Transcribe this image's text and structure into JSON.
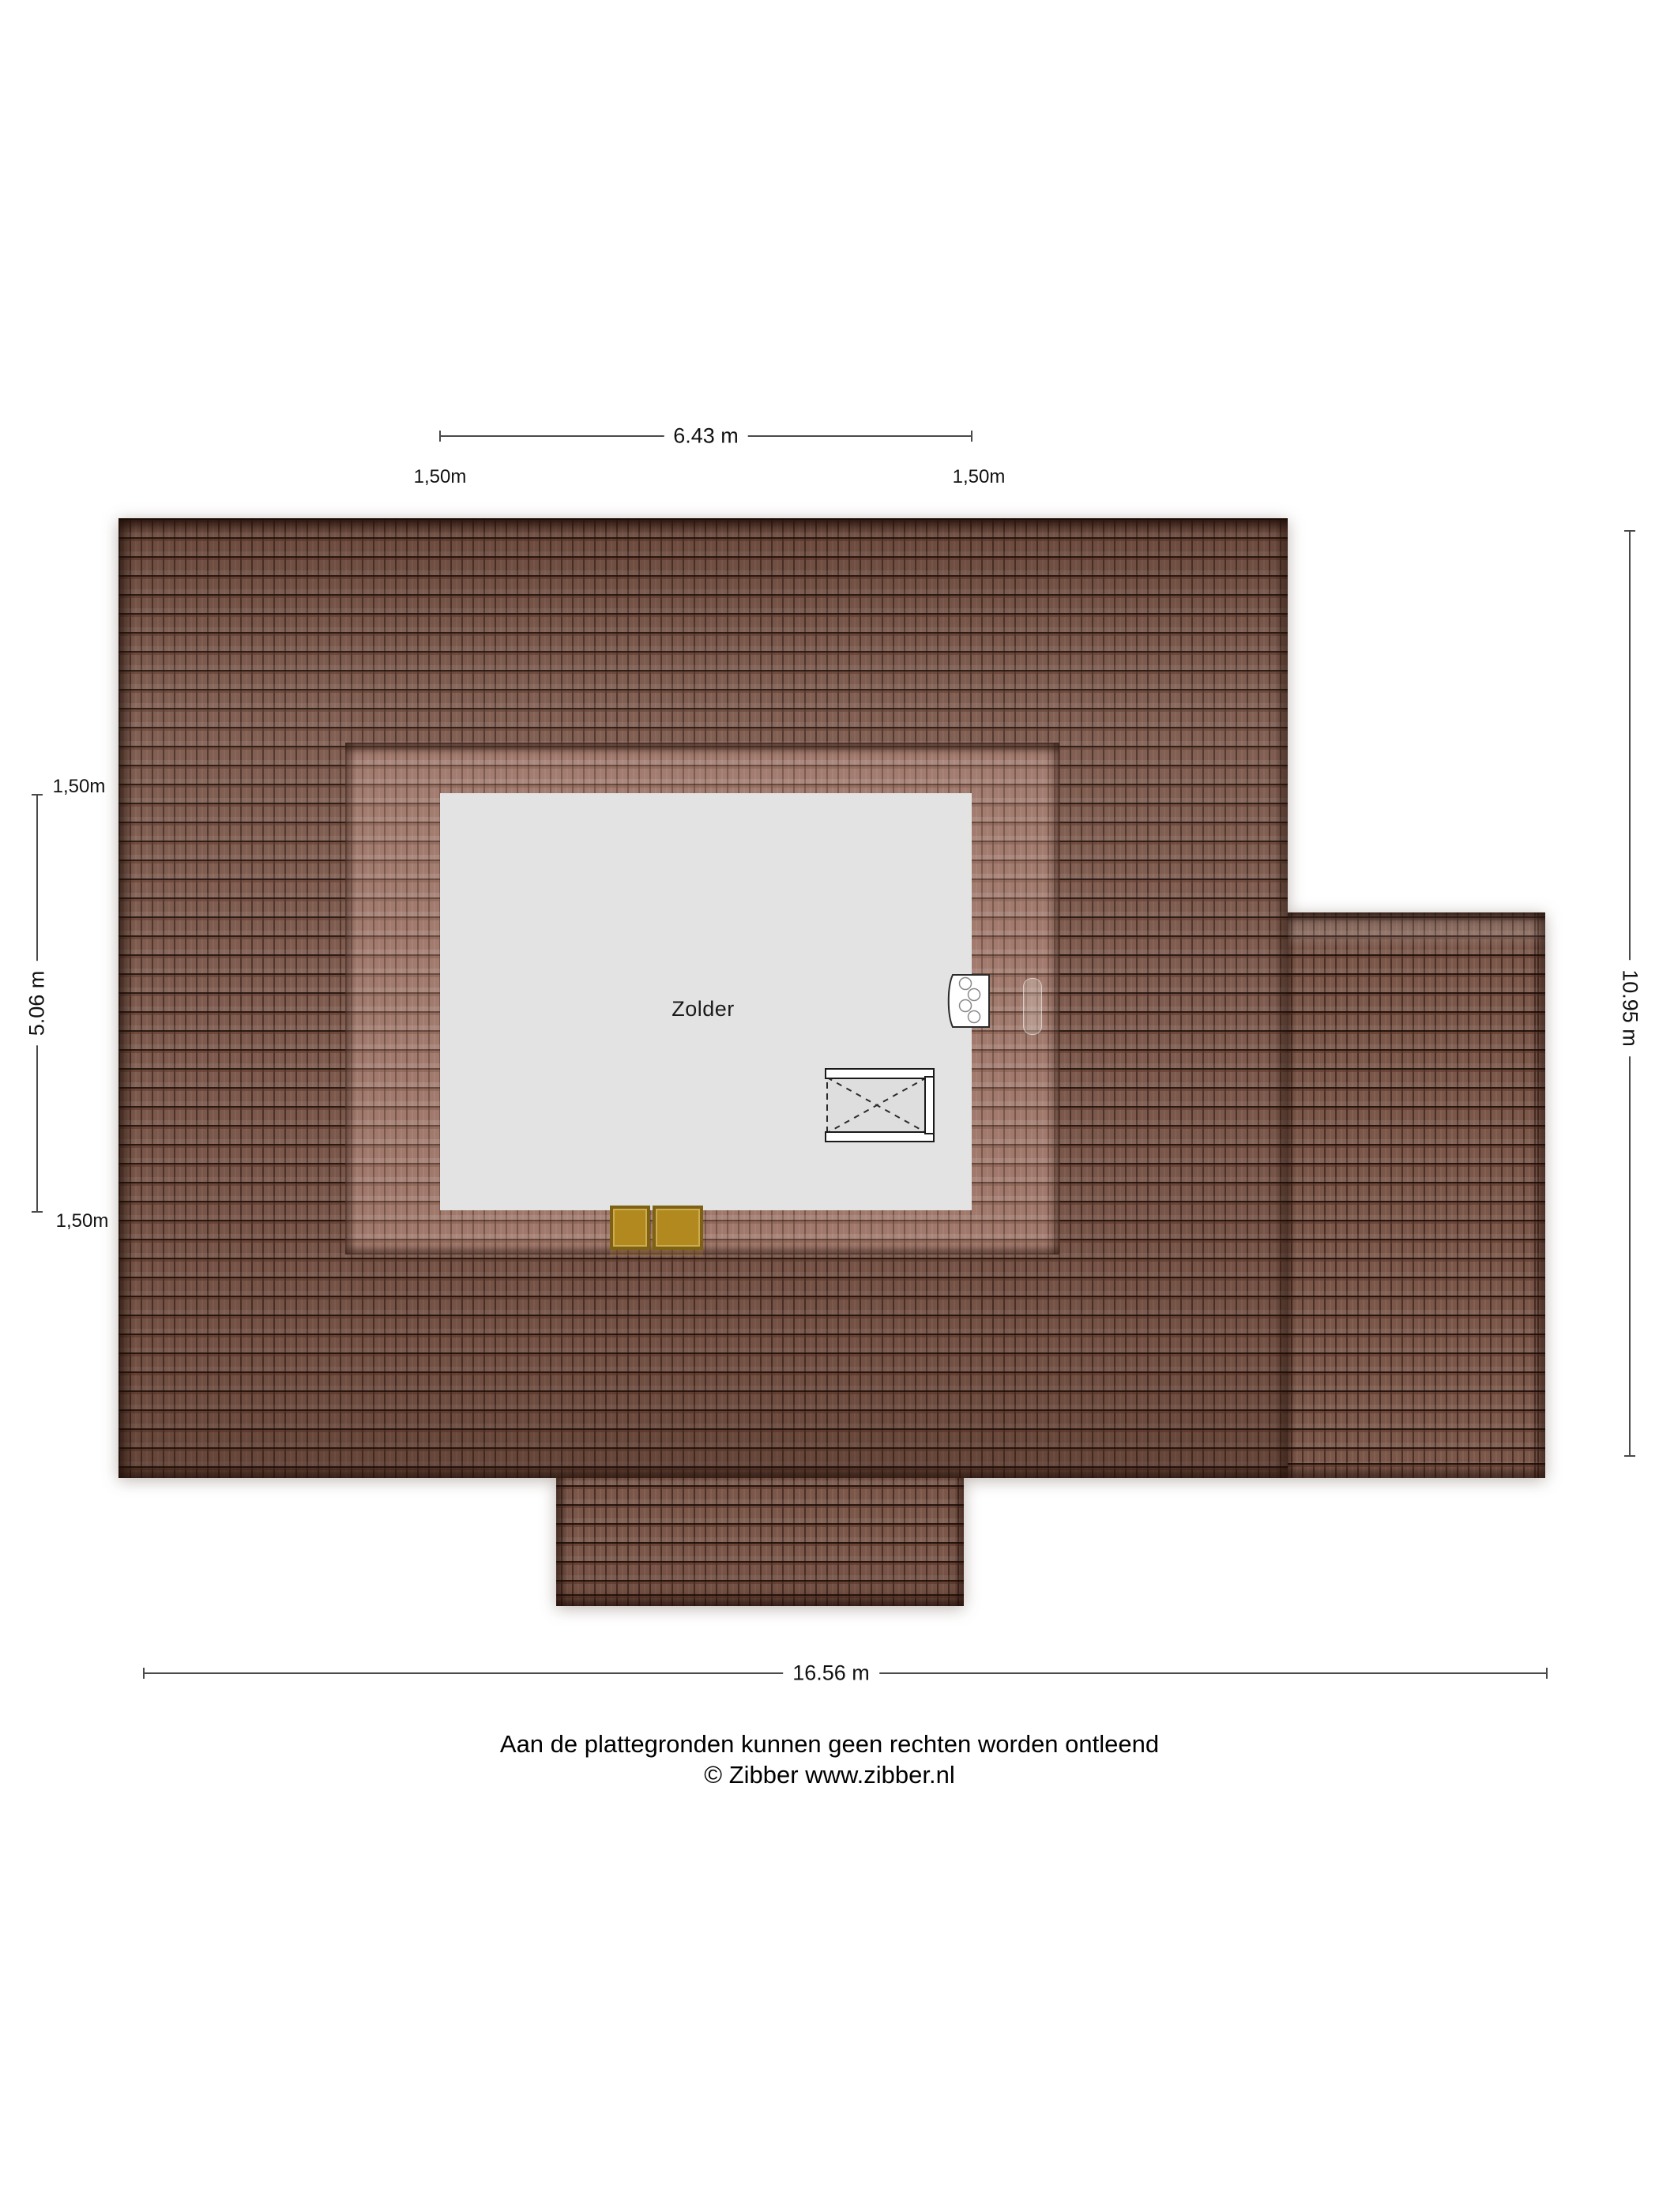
{
  "room": {
    "label": "Zolder"
  },
  "dimensions": {
    "top": {
      "value": "6.43 m",
      "flank_left": "1,50m",
      "flank_right": "1,50m"
    },
    "left": {
      "value": "5.06 m",
      "flank_top": "1,50m",
      "flank_bottom": "1,50m"
    },
    "right": {
      "value": "10.95 m"
    },
    "bottom": {
      "value": "16.56 m"
    }
  },
  "footer": {
    "disclaimer": "Aan de plattegronden kunnen geen rechten worden ontleend",
    "copyright": "© Zibber www.zibber.nl"
  },
  "colors": {
    "roof_tile": "#7b574a",
    "roof_tile_joint": "#35201a",
    "dormer_tile": "#9d7467",
    "room_fill": "#e3e3e3",
    "skylight_gold": "#b1891e",
    "dimension_line": "#4a4a4a",
    "text": "#111111"
  }
}
